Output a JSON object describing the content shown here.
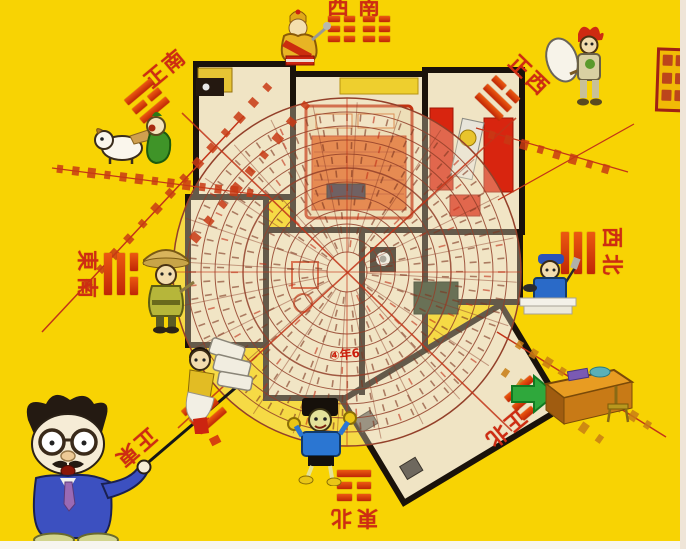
{
  "canvas": {
    "background_color": "#f8d303",
    "frame_color": "#f7f5f0"
  },
  "directions": [
    {
      "id": "south",
      "label": "正南",
      "trigram_name": "li",
      "trigram": [
        1,
        0,
        1
      ]
    },
    {
      "id": "southwest",
      "label": "西南",
      "trigram_name": "kun",
      "trigram": [
        0,
        0,
        0
      ]
    },
    {
      "id": "southeast",
      "label": "東南",
      "trigram_name": "xun",
      "trigram": [
        1,
        1,
        0
      ]
    },
    {
      "id": "east",
      "label": "正東",
      "trigram_name": "zhen",
      "trigram": [
        0,
        0,
        1
      ]
    },
    {
      "id": "northeast",
      "label": "東北",
      "trigram_name": "gen",
      "trigram": [
        1,
        0,
        0
      ]
    },
    {
      "id": "north",
      "label": "正北",
      "trigram_name": "kan",
      "trigram": [
        0,
        1,
        0
      ]
    },
    {
      "id": "northwest",
      "label": "西北",
      "trigram_name": "qian",
      "trigram": [
        1,
        1,
        1
      ]
    },
    {
      "id": "west",
      "label": "正西",
      "trigram_name": "dui",
      "trigram": [
        0,
        1,
        1
      ]
    }
  ],
  "compass": {
    "annotation": "④年6",
    "ring_color": "#93402a",
    "accent_red": "#c23418",
    "disk_tint": "#f3e7c8"
  },
  "floor_plan": {
    "wall_color": "#1a120a",
    "floor_color": "#f0e4c4",
    "furniture": [
      "double-bed",
      "wardrobe",
      "stove",
      "tv-cabinet",
      "washing-machine",
      "red-cabinets",
      "green-cabinet",
      "red-table",
      "desk-with-chair"
    ]
  },
  "characters": [
    "fortune-god",
    "dog-with-sprout",
    "farmer",
    "professor-pointing",
    "money-carrier",
    "running-boy",
    "craftsman",
    "boy-with-sack"
  ],
  "decor": [
    "green-arrow",
    "red-seal-stamp",
    "annotation-text-strokes"
  ]
}
